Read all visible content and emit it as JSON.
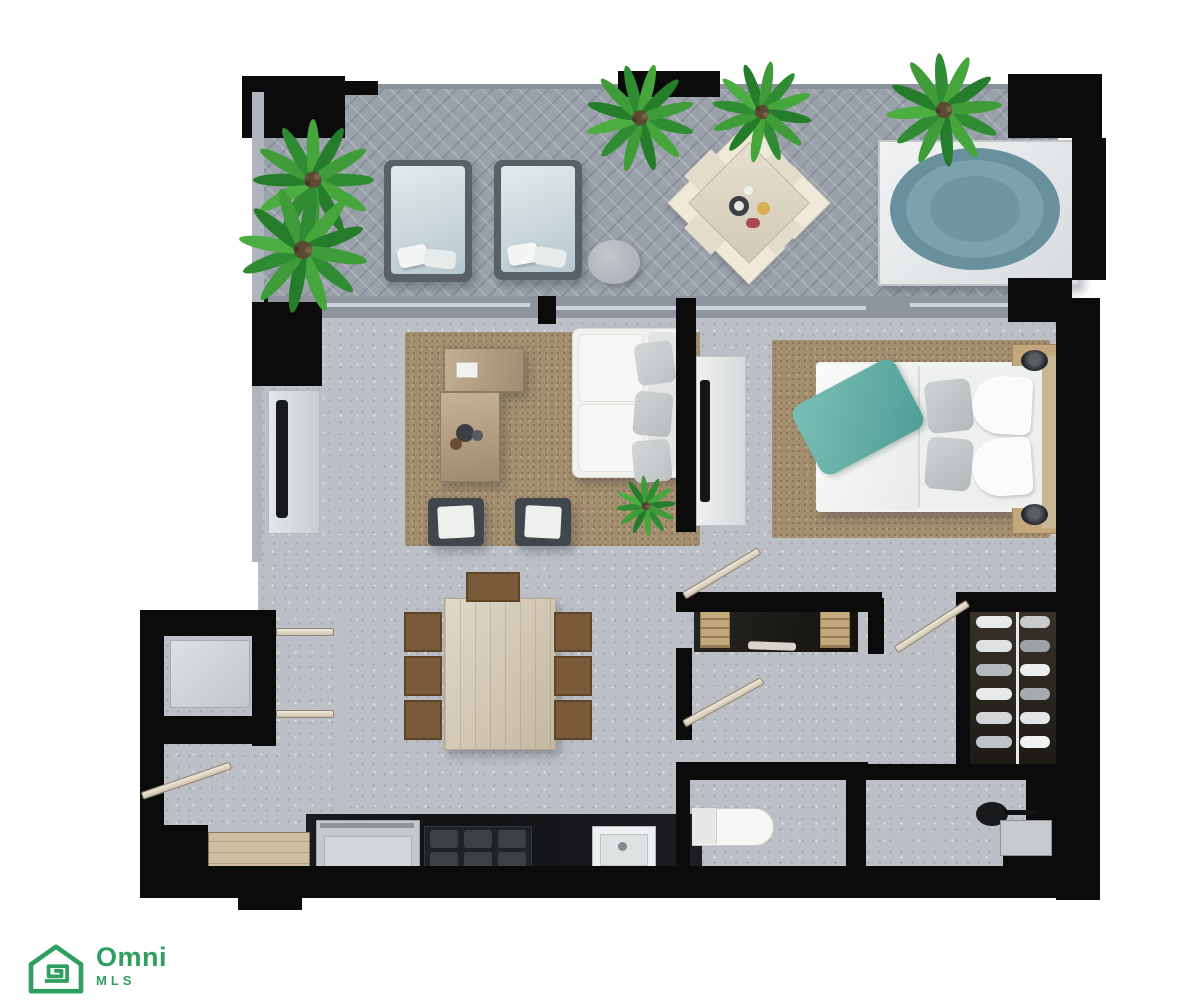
{
  "page": {
    "background": "#ffffff",
    "description": "3D top-down rendered floor plan of a one-bedroom apartment with terrace"
  },
  "branding": {
    "icon": "omni-house-spiral-icon",
    "name": "Omni",
    "subname": "MLS",
    "color": "#2f9f5f"
  },
  "floorplan": {
    "palette": {
      "wall": "#0b0b0c",
      "terrace_tile": "#9aa1ab",
      "interior_floor": "#bcc0c6",
      "rug": "#a38e6f",
      "wood_light": "#cfc3ab",
      "wood_dark": "#7b5a3a",
      "white_furniture": "#f1f2f0",
      "teal_accent": "#64ada6",
      "hot_tub_water": "#6d94a1",
      "plant_green": "#3a9140",
      "console_gray": "#d9dcde"
    },
    "areas": [
      {
        "name": "terrace"
      },
      {
        "name": "living-room"
      },
      {
        "name": "bedroom"
      },
      {
        "name": "dining-area"
      },
      {
        "name": "kitchen"
      },
      {
        "name": "entry-foyer"
      },
      {
        "name": "bathroom"
      },
      {
        "name": "walk-in-closet"
      },
      {
        "name": "shower-room"
      }
    ],
    "furniture": [
      "sun-lounger",
      "sun-lounger",
      "round-side-table",
      "outdoor-dining-set",
      "hot-tub",
      "potted-palm",
      "potted-palm",
      "potted-palm",
      "potted-palm",
      "potted-palm",
      "potted-palm",
      "sofa",
      "coffee-table",
      "coffee-table",
      "armchair",
      "armchair",
      "tv-console",
      "area-rug",
      "area-rug",
      "double-bed",
      "nightstand",
      "nightstand",
      "bedroom-tv-console",
      "dining-table",
      "dining-chair",
      "dining-chair",
      "dining-chair",
      "dining-chair",
      "dining-chair",
      "dining-chair",
      "dining-chair",
      "kitchen-counter",
      "range",
      "cooktop",
      "kitchen-sink",
      "pantry-cabinet",
      "washer",
      "bathroom-vanity",
      "toilet",
      "shower-head",
      "shower-bench",
      "wardrobe-rail"
    ]
  }
}
